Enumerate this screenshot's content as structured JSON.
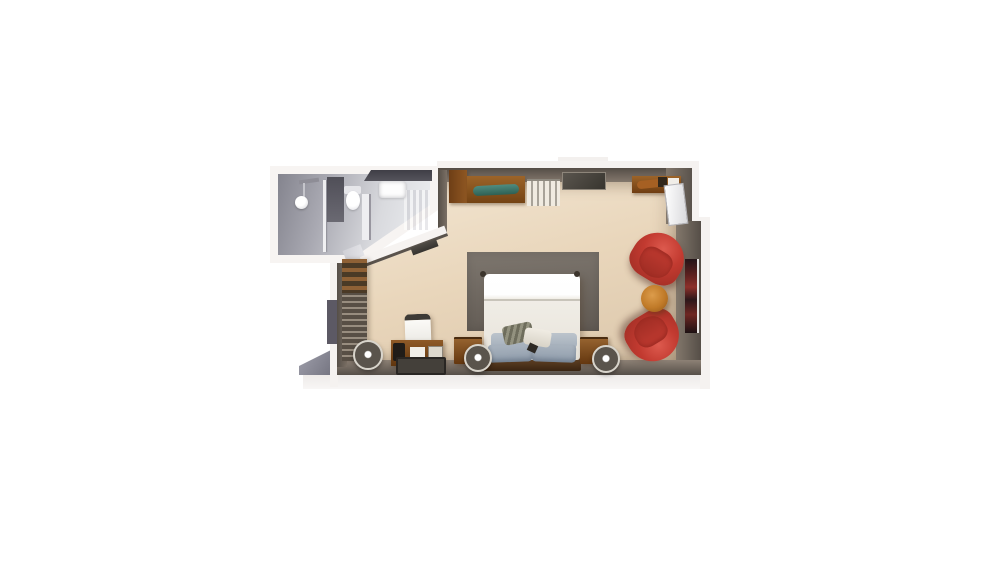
{
  "scene": {
    "title": "3D top-down floor plan of a hotel guest room with en-suite bathroom",
    "background": "#ffffff"
  },
  "palette": {
    "floor_wood": "#e9d8bf",
    "wall_top": "#6f655c",
    "wall_dark": "#57504a",
    "wall_exterior": "#f5f2f0",
    "bathroom_floor_dark": "#84848e",
    "bathroom_floor_light": "#eef0f3",
    "wood_furniture": "#8a5527",
    "wood_dark": "#6b3d1c",
    "armchair_red": "#c23a30",
    "armchair_red_dark": "#9e2d24",
    "area_rug_gray": "#6e675f",
    "bed_linen_white": "#f4f1ec",
    "pillow_blue_gray": "#a2aeba",
    "accent_teal": "#3f7a70",
    "side_table_orange": "#c07a28",
    "artwork_dark_red": "#6b2521"
  },
  "bathroom": {
    "label": "Bathroom",
    "shower": "Walk-in shower",
    "shower_head": "Rain shower head",
    "glass": "Glass shower screen",
    "toilet": "Toilet",
    "partition": "Partition wall",
    "vanity": "Vanity counter",
    "sink": "Sink",
    "door": "Bathroom doorway",
    "tiles": "Tiled floor"
  },
  "bedroom": {
    "label": "Bedroom and sitting area",
    "entry": "Entry door recess",
    "wardrobe": "Open wardrobe shelving",
    "floor_lamp": "Floor lamp",
    "credenza": "Dresser with teal cushion",
    "radiator": "Radiator",
    "dressing_table": "Console table",
    "window_upper": "Window",
    "window_left": "Window",
    "artwork": "Wall artwork",
    "area_rug": "Dark area rug",
    "bed": "Double bed with white duvet",
    "duvet": "White duvet",
    "pillows": "Blue-gray pillows",
    "cushions": "Decorative cushions",
    "headboard": "Wooden headboard",
    "nightstand_left": "Left nightstand with table lamp",
    "nightstand_right": "Right nightstand with table lamp",
    "table_lamp": "Table lamp",
    "desk": "Writing desk",
    "desk_chair": "Desk chair",
    "desk_rug": "Dark floor mat",
    "armchair_top": "Red armchair",
    "armchair_bottom": "Red armchair",
    "side_table": "Round wooden side table"
  }
}
